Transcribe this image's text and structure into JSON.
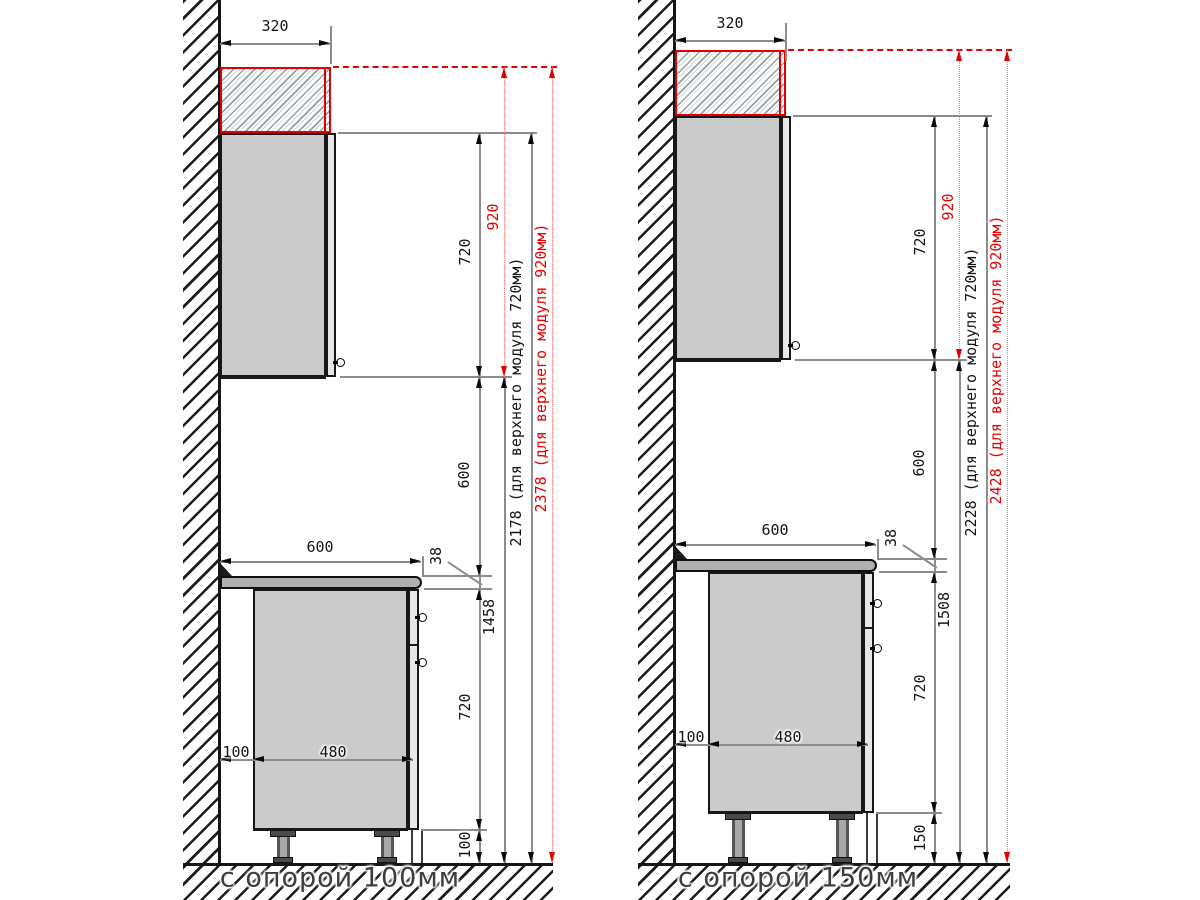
{
  "title": "Схема установки кухонных модулей",
  "colors": {
    "accent_red": "#e60000",
    "line_gray": "#8c8c8c",
    "cabinet_fill": "#cbcbcb",
    "countertop_fill": "#b0b0b0"
  },
  "diagrams": [
    {
      "caption": "с опорой 100мм",
      "dims": {
        "upper_depth": "320",
        "upper_module_height": "720",
        "upper_module_alt_height": "920",
        "worktop_to_upper": "600",
        "worktop_thickness": "38",
        "worktop_depth": "600",
        "wall_gap": "100",
        "base_depth": "480",
        "base_height": "720",
        "support_height": "100",
        "floor_to_upper": "1458",
        "total_height_720": "2178 (для верхнего модуля 720мм)",
        "total_height_920": "2378 (для верхнего модуля 920мм)"
      }
    },
    {
      "caption": "с опорой 150мм",
      "dims": {
        "upper_depth": "320",
        "upper_module_height": "720",
        "upper_module_alt_height": "920",
        "worktop_to_upper": "600",
        "worktop_thickness": "38",
        "worktop_depth": "600",
        "wall_gap": "100",
        "base_depth": "480",
        "base_height": "720",
        "support_height": "150",
        "floor_to_upper": "1508",
        "total_height_720": "2228 (для верхнего модуля 720мм)",
        "total_height_920": "2428 (для верхнего модуля 920мм)"
      }
    }
  ]
}
